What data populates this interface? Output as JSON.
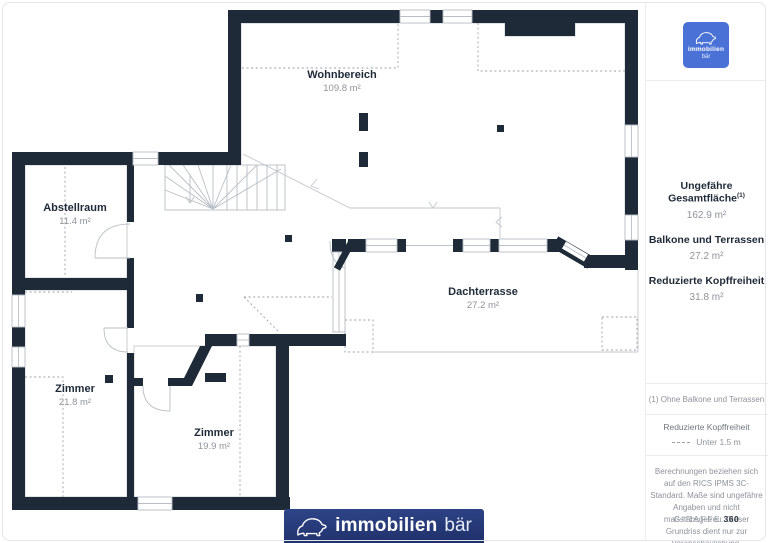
{
  "canvas": {
    "width": 768,
    "height": 543,
    "background": "#ffffff",
    "border_color": "#e3e6ea"
  },
  "branding": {
    "corner_logo": {
      "line1": "immobilien",
      "line2": "bär",
      "bg_color": "#4a72d6",
      "icon": "bear-icon"
    },
    "banner": {
      "text_bold": "immobilien",
      "text_light": "bär",
      "bg_color": "#24377b",
      "icon": "bear-icon"
    }
  },
  "sidebar": {
    "metrics": [
      {
        "label": "Ungefähre Gesamtfläche",
        "footnote_ref": "(1)",
        "value": "162.9 m²"
      },
      {
        "label": "Balkone und Terrassen",
        "value": "27.2 m²"
      },
      {
        "label": "Reduzierte Kopffreiheit",
        "value": "31.8 m²"
      }
    ],
    "footnote": "(1) Ohne Balkone und Terrassen",
    "legend": {
      "title": "Reduzierte Kopffreiheit",
      "item_label": "Unter 1.5 m",
      "line_style": "dashed"
    },
    "disclaimer": "Berechnungen beziehen sich auf den RICS IPMS 3C-Standard. Maße sind ungefähre Angaben und nicht maßstabsgetreu. Dieser Grundriss dient nur zur Veranschaulichung.",
    "provider": {
      "name": "GIRAFFE",
      "suffix": "360"
    }
  },
  "floorplan": {
    "rooms": [
      {
        "name": "Wohnbereich",
        "area": "109.8 m²"
      },
      {
        "name": "Abstellraum",
        "area": "11.4 m²"
      },
      {
        "name": "Dachterrasse",
        "area": "27.2 m²"
      },
      {
        "name": "Zimmer",
        "area": "21.8 m²"
      },
      {
        "name": "Zimmer",
        "area": "19.9 m²"
      }
    ],
    "colors": {
      "wall": "#1e2a38",
      "thin_line": "#b9bfc6",
      "dashed_line": "#9aa1a9",
      "label": "#1e2a38",
      "value": "#8d939b"
    }
  }
}
